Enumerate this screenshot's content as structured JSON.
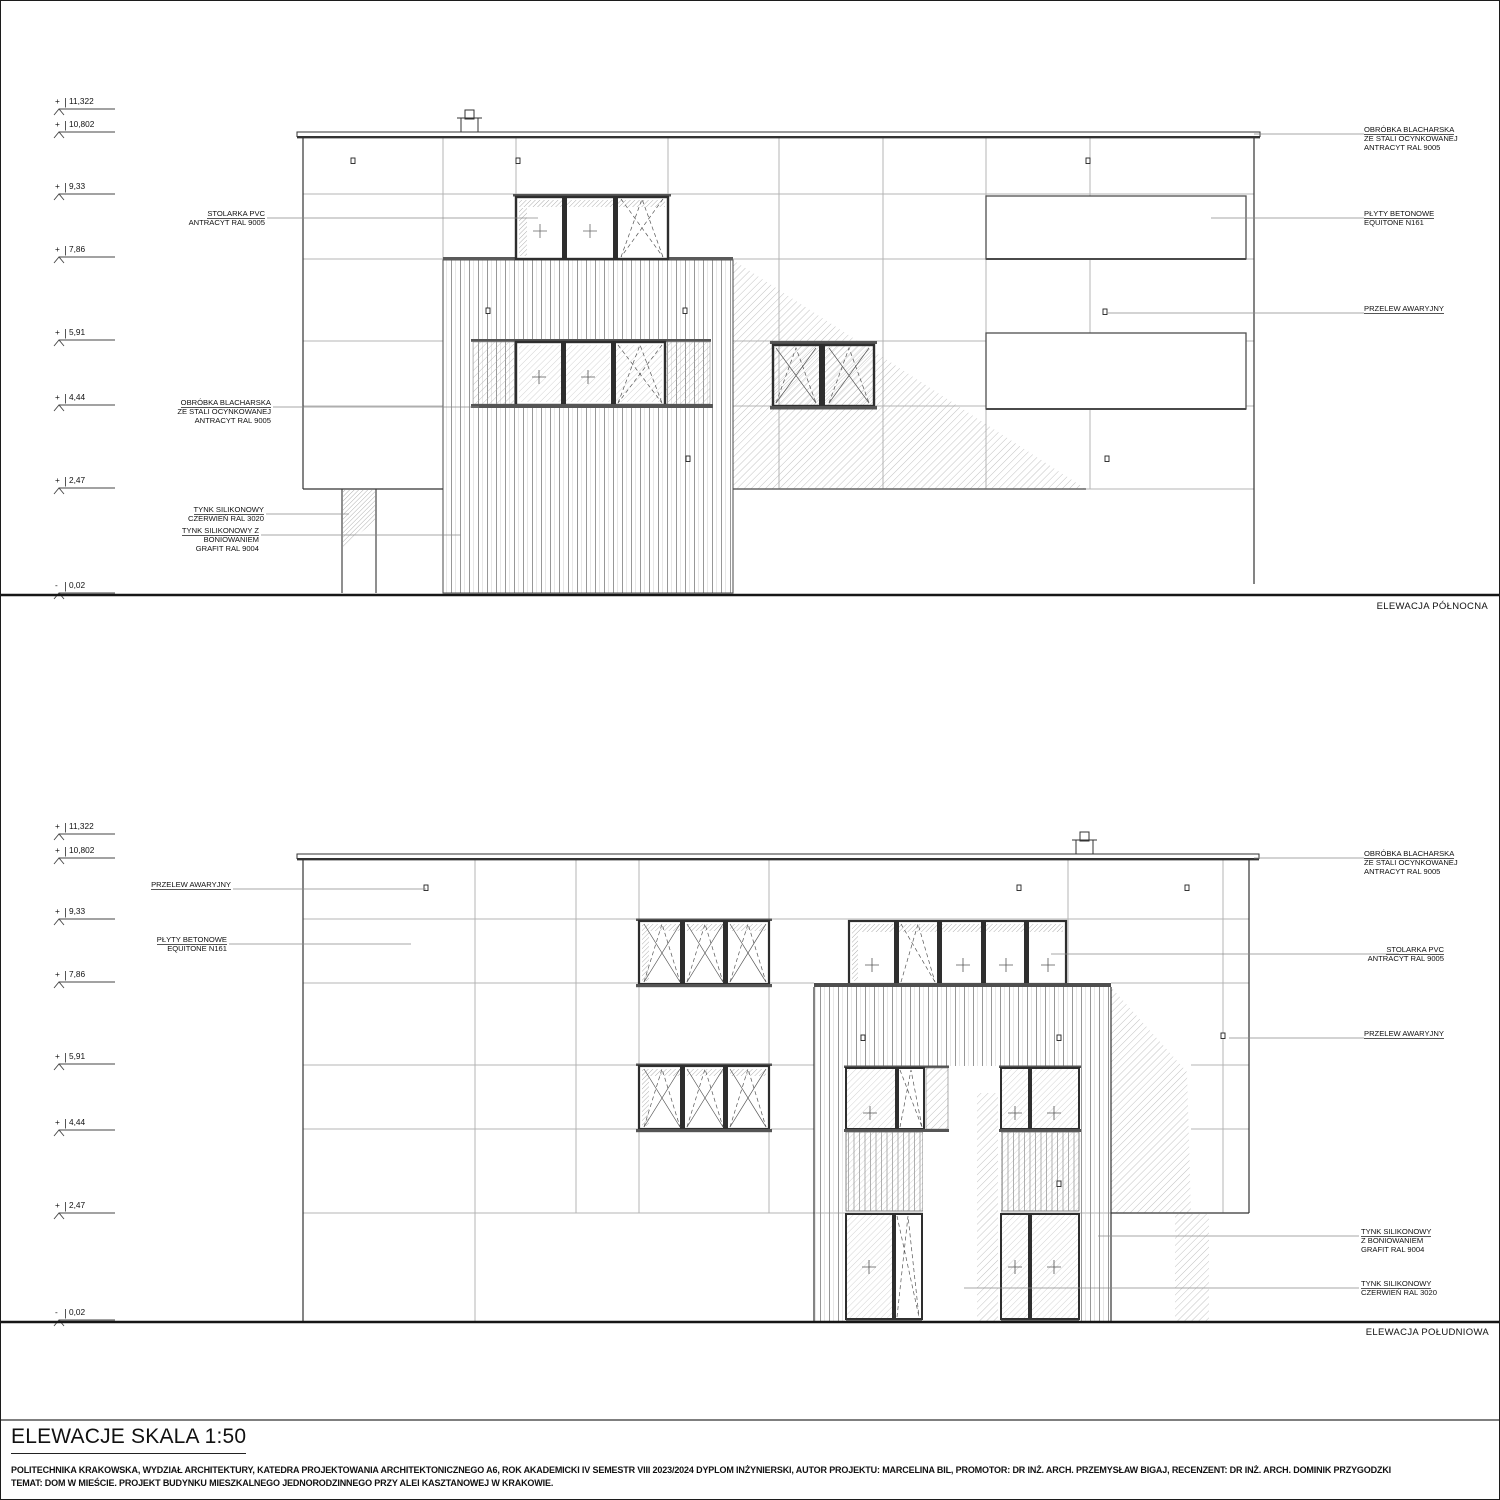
{
  "colors": {
    "ink": "#111111",
    "line": "#3a3a3a",
    "grid": "#b4b4b4",
    "hatch": "#a8a8a8",
    "background": "#ffffff"
  },
  "levels": [
    {
      "sign": "+",
      "value": "11,322"
    },
    {
      "sign": "+",
      "value": "10,802"
    },
    {
      "sign": "+",
      "value": "9,33"
    },
    {
      "sign": "+",
      "value": "7,86"
    },
    {
      "sign": "+",
      "value": "5,91"
    },
    {
      "sign": "+",
      "value": "4,44"
    },
    {
      "sign": "+",
      "value": "2,47"
    },
    {
      "sign": "-",
      "value": "0,02"
    }
  ],
  "north": {
    "label": "ELEWACJA PÓŁNOCNA",
    "left_annotations": [
      {
        "lines": [
          "STOLARKA PVC",
          "ANTRACYT RAL 9005"
        ]
      },
      {
        "lines": [
          "OBRÓBKA BLACHARSKA",
          "ZE STALI OCYNKOWANEJ",
          "ANTRACYT RAL 9005"
        ]
      },
      {
        "lines": [
          "TYNK SILIKONOWY",
          "CZERWIEŃ RAL 3020"
        ]
      },
      {
        "lines": [
          "TYNK SILIKONOWY Z",
          "BONIOWANIEM",
          "GRAFIT RAL 9004"
        ]
      }
    ],
    "right_annotations": [
      {
        "lines": [
          "OBRÓBKA BLACHARSKA",
          "ZE STALI OCYNKOWANEJ",
          "ANTRACYT RAL 9005"
        ]
      },
      {
        "lines": [
          "PŁYTY BETONOWE",
          "EQUITONE N161"
        ]
      },
      {
        "lines": [
          "PRZELEW AWARYJNY"
        ]
      }
    ]
  },
  "south": {
    "label": "ELEWACJA POŁUDNIOWA",
    "left_annotations": [
      {
        "lines": [
          "PRZELEW AWARYJNY"
        ]
      },
      {
        "lines": [
          "PŁYTY BETONOWE",
          "EQUITONE N161"
        ]
      }
    ],
    "right_annotations": [
      {
        "lines": [
          "OBRÓBKA BLACHARSKA",
          "ZE STALI OCYNKOWANEJ",
          "ANTRACYT RAL 9005"
        ]
      },
      {
        "lines": [
          "STOLARKA PVC",
          "ANTRACYT RAL 9005"
        ]
      },
      {
        "lines": [
          "PRZELEW AWARYJNY"
        ]
      },
      {
        "lines": [
          "TYNK SILIKONOWY",
          "Z BONIOWANIEM",
          "GRAFIT RAL 9004"
        ]
      },
      {
        "lines": [
          "TYNK SILIKONOWY",
          "CZERWIEŃ RAL 3020"
        ]
      }
    ]
  },
  "title_block": {
    "title": "ELEWACJE SKALA 1:50",
    "footer_line1": "POLITECHNIKA KRAKOWSKA, WYDZIAŁ ARCHITEKTURY, KATEDRA PROJEKTOWANIA ARCHITEKTONICZNEGO A6, ROK AKADEMICKI IV SEMESTR VIII 2023/2024 DYPLOM INŻYNIERSKI, AUTOR PROJEKTU: MARCELINA BIL, PROMOTOR: DR INŻ. ARCH. PRZEMYSŁAW BIGAJ, RECENZENT: DR INŻ. ARCH. DOMINIK PRZYGODZKI",
    "footer_line2": "TEMAT: DOM W MIEŚCIE. PROJEKT BUDYNKU MIESZKALNEGO JEDNORODZINNEGO PRZY ALEI KASZTANOWEJ W KRAKOWIE."
  }
}
